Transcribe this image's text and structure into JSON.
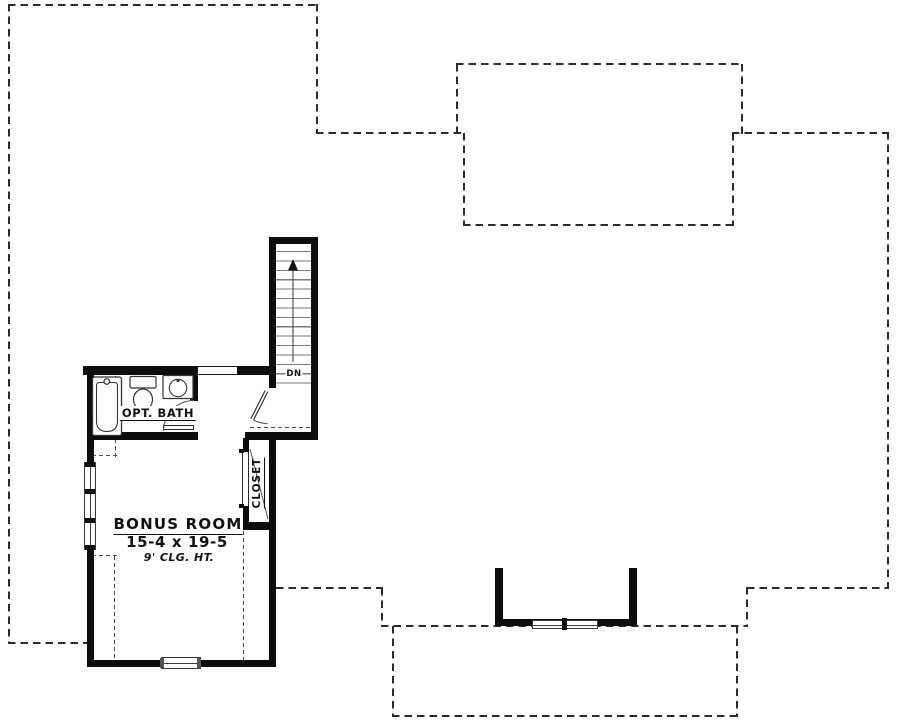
{
  "plan": {
    "bonus_room": {
      "name": "BONUS ROOM",
      "dimensions": "15-4 x 19-5",
      "ceiling_height": "9' CLG. HT."
    },
    "bath": {
      "name": "OPT. BATH"
    },
    "closet": {
      "name": "CLOSET"
    },
    "stairs": {
      "direction_label": "DN"
    },
    "icons": {
      "stair_direction_arrow": "up-arrow"
    },
    "colors": {
      "walls": "#0d0d0d",
      "roof_outline_dash": "#2b2b2b",
      "ceiling_break_dash": "#4a4a4a",
      "fixtures": "#3a3a3a",
      "stair_treads": "#7a7a7a",
      "text": "#111111",
      "background": "#ffffff"
    }
  }
}
